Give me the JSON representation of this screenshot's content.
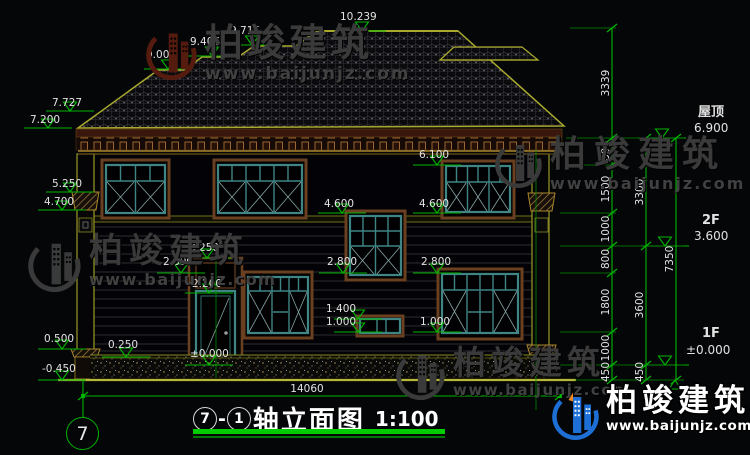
{
  "watermark": {
    "brand": "柏竣建筑",
    "url": "www.baijunjz.com"
  },
  "logo": {
    "brand": "柏竣建筑",
    "url": "www.baijunjz.com"
  },
  "title": {
    "axis_from": "7",
    "sep": "-",
    "axis_to": "1",
    "text": "轴立面图",
    "scale": "1:100"
  },
  "axis": {
    "bubble": "7"
  },
  "dims": {
    "total_width": "14060",
    "top": {
      "a": "9.001",
      "b": "9.406",
      "c": "9.715",
      "d": "10.239"
    },
    "left": {
      "a": "7.727",
      "b": "7.200",
      "c": "5.250",
      "d": "4.700",
      "e": "0.500",
      "f": "0.250",
      "g": "-0.450"
    },
    "mid": {
      "a": "6.100",
      "b": "4.600",
      "c": "4.600",
      "d": "3.250",
      "e": "2.800",
      "f": "2.800",
      "g": "2.800",
      "h": "2.200",
      "i": "1.400",
      "j": "1.000",
      "k": "1.000",
      "l": "±0.000"
    },
    "chain1": {
      "s1": "3339",
      "s2": "800",
      "s3": "1500",
      "s4": "1000",
      "s5": "800",
      "s6": "1800",
      "s7": "1000",
      "s8": "450"
    },
    "chain2": {
      "s1": "3300",
      "s2": "3600",
      "s3": "450"
    },
    "chain3": {
      "s1": "7350"
    }
  },
  "floors": {
    "roof": {
      "name": "屋顶",
      "level": "6.900"
    },
    "f2": {
      "name": "2F",
      "level": "3.600"
    },
    "f1": {
      "name": "1F",
      "level": "±0.000"
    }
  },
  "colors": {
    "bg": "#050608",
    "dim-green": "#00b400",
    "line-yellow": "#a9a92e",
    "text-white": "#e2e2e2",
    "window-teal": "#3f8585",
    "trim-brown": "#6a4020",
    "fascia-maroon": "#3a170c",
    "hatch-tan": "#a8862a",
    "watermark-gray": "#3a3a3a",
    "watermark-maroon": "#541b0e",
    "brand-blue": "#1d6fd6",
    "brand-orange": "#f08a1f",
    "title-green": "#00cc00"
  }
}
